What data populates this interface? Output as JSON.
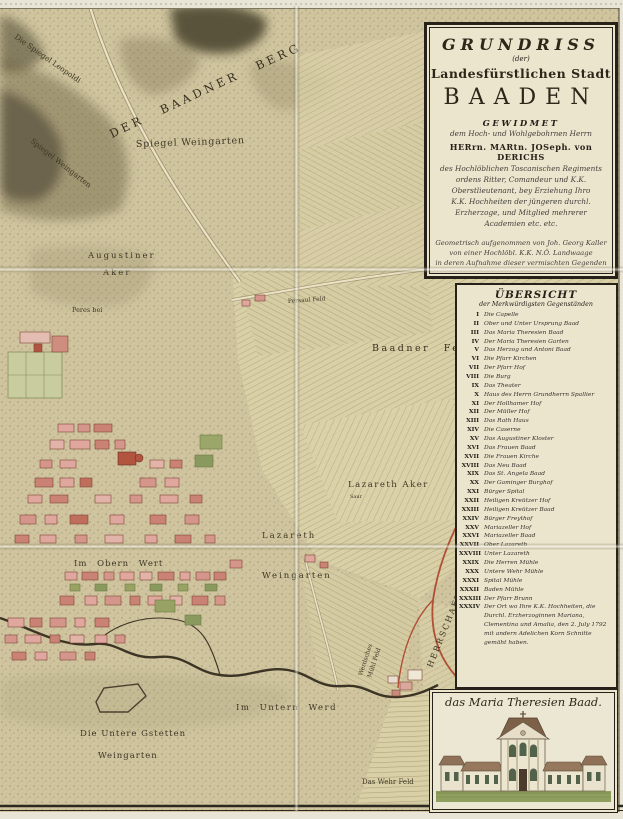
{
  "title_cartouche": {
    "title": "GRUNDRISS",
    "der_line": "(der)",
    "subtitle": "Landesfürstlichen Stadt",
    "city": "BAADEN",
    "gewidmet": "GEWIDMET",
    "dedication_to": "dem Hoch- und Wohlgebohrnen Herrn",
    "dedicatee": "HERrn. MARtn. JOSeph. von DERICHS",
    "dedication_lines": [
      "des Hochlöblichen Toscanischen Regiments",
      "ordens Ritter, Comandeur und K.K.",
      "Oberstlieutenant, bey Erziehung Ihro",
      "K.K. Hochheiten der jüngeren durchl.",
      "Erzherzoge, und Mitglied mehrerer",
      "Academien etc. etc."
    ],
    "surveyor_lines": [
      "Geometrisch aufgenommen von Joh. Georg Kaller",
      "von einer Hochlöbl. K.K. N.Ö. Landwaage",
      "in deren Aufnahme dieser vermischten Gegenden"
    ],
    "engraver_line": "Gestochen von Hieronymus Benedicti in Wien 1798."
  },
  "legend": {
    "title": "ÜBERSICHT",
    "subtitle": "der Merkwürdigsten Gegenständen",
    "items": [
      {
        "num": "I",
        "label": "Die Capelle"
      },
      {
        "num": "II",
        "label": "Ober und Unter Ursprung Baad"
      },
      {
        "num": "III",
        "label": "Das Maria Theresien Baad"
      },
      {
        "num": "IV",
        "label": "Der Maria Theresien Garten"
      },
      {
        "num": "V",
        "label": "Das Herzog und Antoni Baad"
      },
      {
        "num": "VI",
        "label": "Die Pfarr Kirchen"
      },
      {
        "num": "VII",
        "label": "Der Pfarr Hof"
      },
      {
        "num": "VIII",
        "label": "Die Burg"
      },
      {
        "num": "IX",
        "label": "Das Theater"
      },
      {
        "num": "X",
        "label": "Haus des Herrn Grundherrn Spallier"
      },
      {
        "num": "XI",
        "label": "Der Hollhamer Hof"
      },
      {
        "num": "XII",
        "label": "Der Müller Hof"
      },
      {
        "num": "XIII",
        "label": "Das Rath Haus"
      },
      {
        "num": "XIV",
        "label": "Die Caserne"
      },
      {
        "num": "XV",
        "label": "Das Augustiner Kloster"
      },
      {
        "num": "XVI",
        "label": "Das Frauen Baad"
      },
      {
        "num": "XVII",
        "label": "Die Frauen Kirche"
      },
      {
        "num": "XVIII",
        "label": "Das Neu Baad"
      },
      {
        "num": "XIX",
        "label": "Das St. Angela Baad"
      },
      {
        "num": "XX",
        "label": "Der Gaminger Burghof"
      },
      {
        "num": "XXI",
        "label": "Bürger Spital"
      },
      {
        "num": "XXII",
        "label": "Heiligen Kreützer Hof"
      },
      {
        "num": "XXIII",
        "label": "Heiligen Kreützer Baad"
      },
      {
        "num": "XXIV",
        "label": "Bürger Freythof"
      },
      {
        "num": "XXV",
        "label": "Mariazeller Hof"
      },
      {
        "num": "XXVI",
        "label": "Mariazeller Baad"
      },
      {
        "num": "XXVII",
        "label": "Ober Lazareth"
      },
      {
        "num": "XXVIII",
        "label": "Unter Lazareth"
      },
      {
        "num": "XXIX",
        "label": "Die Herren Mühle"
      },
      {
        "num": "XXX",
        "label": "Untere Wehr Mühle"
      },
      {
        "num": "XXXI",
        "label": "Spital Mühle"
      },
      {
        "num": "XXXII",
        "label": "Baden Mühle"
      },
      {
        "num": "XXXIII",
        "label": "Der Pfarr Brunn"
      },
      {
        "num": "XXXIV",
        "label": "Der Ort wo Ihre K.K. Hochheiten, die Durchl. Erzherzoginnen Mariana, Clementina und Amalia, den 2. July 1792 mit andern Adelichen Korn Schnitte gemäht haben."
      }
    ]
  },
  "vignette": {
    "caption": "das Maria Theresien Baad."
  },
  "map_labels": {
    "der_baadner_berg": "DER BAADNER BERG",
    "spiegel_weingarten": "Spiegel Weingarten",
    "spiegel_weingarten_diag": "Spiegel Weingarten",
    "leopoldi": "Die Spiegel Leopoldi",
    "augustiner_1": "Augustiner",
    "augustiner_2": "Aker",
    "peres_bei": "Peres bei",
    "persaul_feld": "Persaul Feld",
    "baadner_feld": "Baadner Feld",
    "lazareth_aker": "Lazareth Aker",
    "saur": "Saur",
    "lazareth": "Lazareth",
    "weingarten_mid": "Weingarten",
    "im_obern_wert": "Im Obern Wert",
    "werdsches_1": "Werdsches",
    "werdsches_2": "Mühl Feld",
    "im_untern_werd": "Im Untern Werd",
    "untere_gstetten": "Die Untere Gstetten",
    "weingarten_low": "Weingarten",
    "das_wehr_feld": "Das Wehr Feld",
    "herrschaft_leesdorf": "HERRSCHAFT LEESDORF"
  },
  "colors": {
    "parchment": "#cfc49e",
    "panel_cream": "#ebe5ce",
    "ink": "#26221a",
    "town_pink": "#dca79c",
    "accent_red": "#b14f36",
    "hill_dark": "#4a4430",
    "field_line": "#b4a97e",
    "garden_green": "#97a263",
    "stream_brown": "#3c3424"
  }
}
